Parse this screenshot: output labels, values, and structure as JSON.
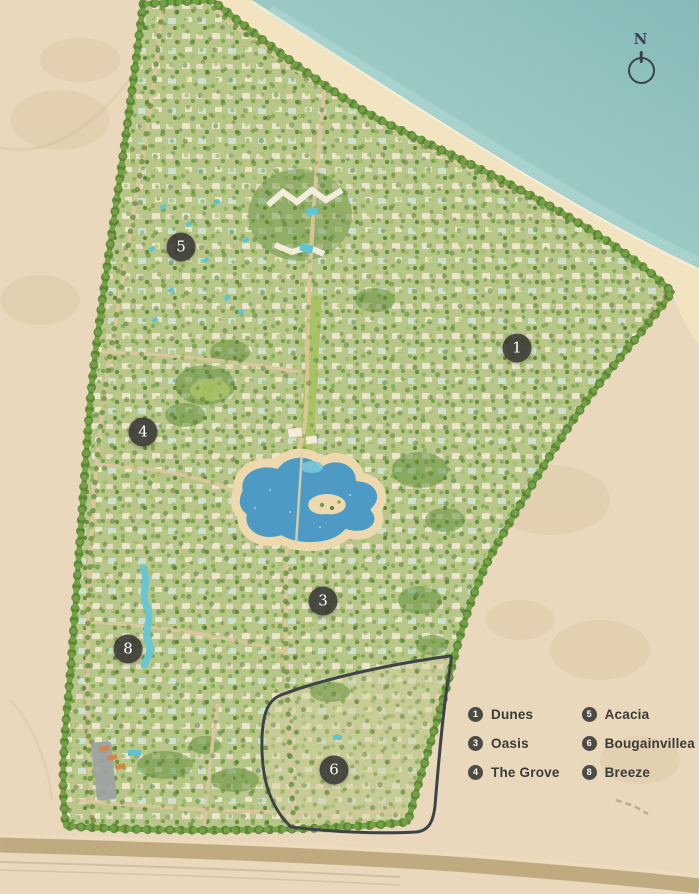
{
  "map": {
    "compass": {
      "label": "N"
    },
    "markers": [
      {
        "number": "1",
        "zone": "Dunes"
      },
      {
        "number": "3",
        "zone": "Oasis"
      },
      {
        "number": "4",
        "zone": "The Grove"
      },
      {
        "number": "5",
        "zone": "Acacia"
      },
      {
        "number": "6",
        "zone": "Bougainvillea"
      },
      {
        "number": "8",
        "zone": "Breeze"
      }
    ]
  },
  "legend": {
    "columns": [
      {
        "items": [
          {
            "number": "1",
            "label": "Dunes"
          },
          {
            "number": "3",
            "label": "Oasis"
          },
          {
            "number": "4",
            "label": "The Grove"
          }
        ]
      },
      {
        "items": [
          {
            "number": "5",
            "label": "Acacia"
          },
          {
            "number": "6",
            "label": "Bougainvillea"
          },
          {
            "number": "8",
            "label": "Breeze"
          }
        ]
      }
    ]
  },
  "colors": {
    "sand": "#e9d8bb",
    "beach": "#f3e4c1",
    "water_light": "#b3d8d2",
    "water_deep": "#84bab8",
    "dev_green": "#b9c68a",
    "tree_dark": "#4e7a31",
    "tree_mid": "#6f9e42",
    "tree_light": "#8cb94f",
    "road": "#dbc79d",
    "lake": "#4d9bc5",
    "lake_shore": "#edd9ad",
    "pool": "#5fc3d2",
    "zone_outline": "#3e4347",
    "marker_bg": "rgba(56,55,52,0.88)",
    "marker_text": "#ffffff",
    "legend_text": "#3b3a38",
    "compass": "#3d434e",
    "highway": "#c0aa80",
    "parking": "#9ba1a3",
    "building_white": "#f1e9d2",
    "roof_orange": "#d4854a"
  }
}
